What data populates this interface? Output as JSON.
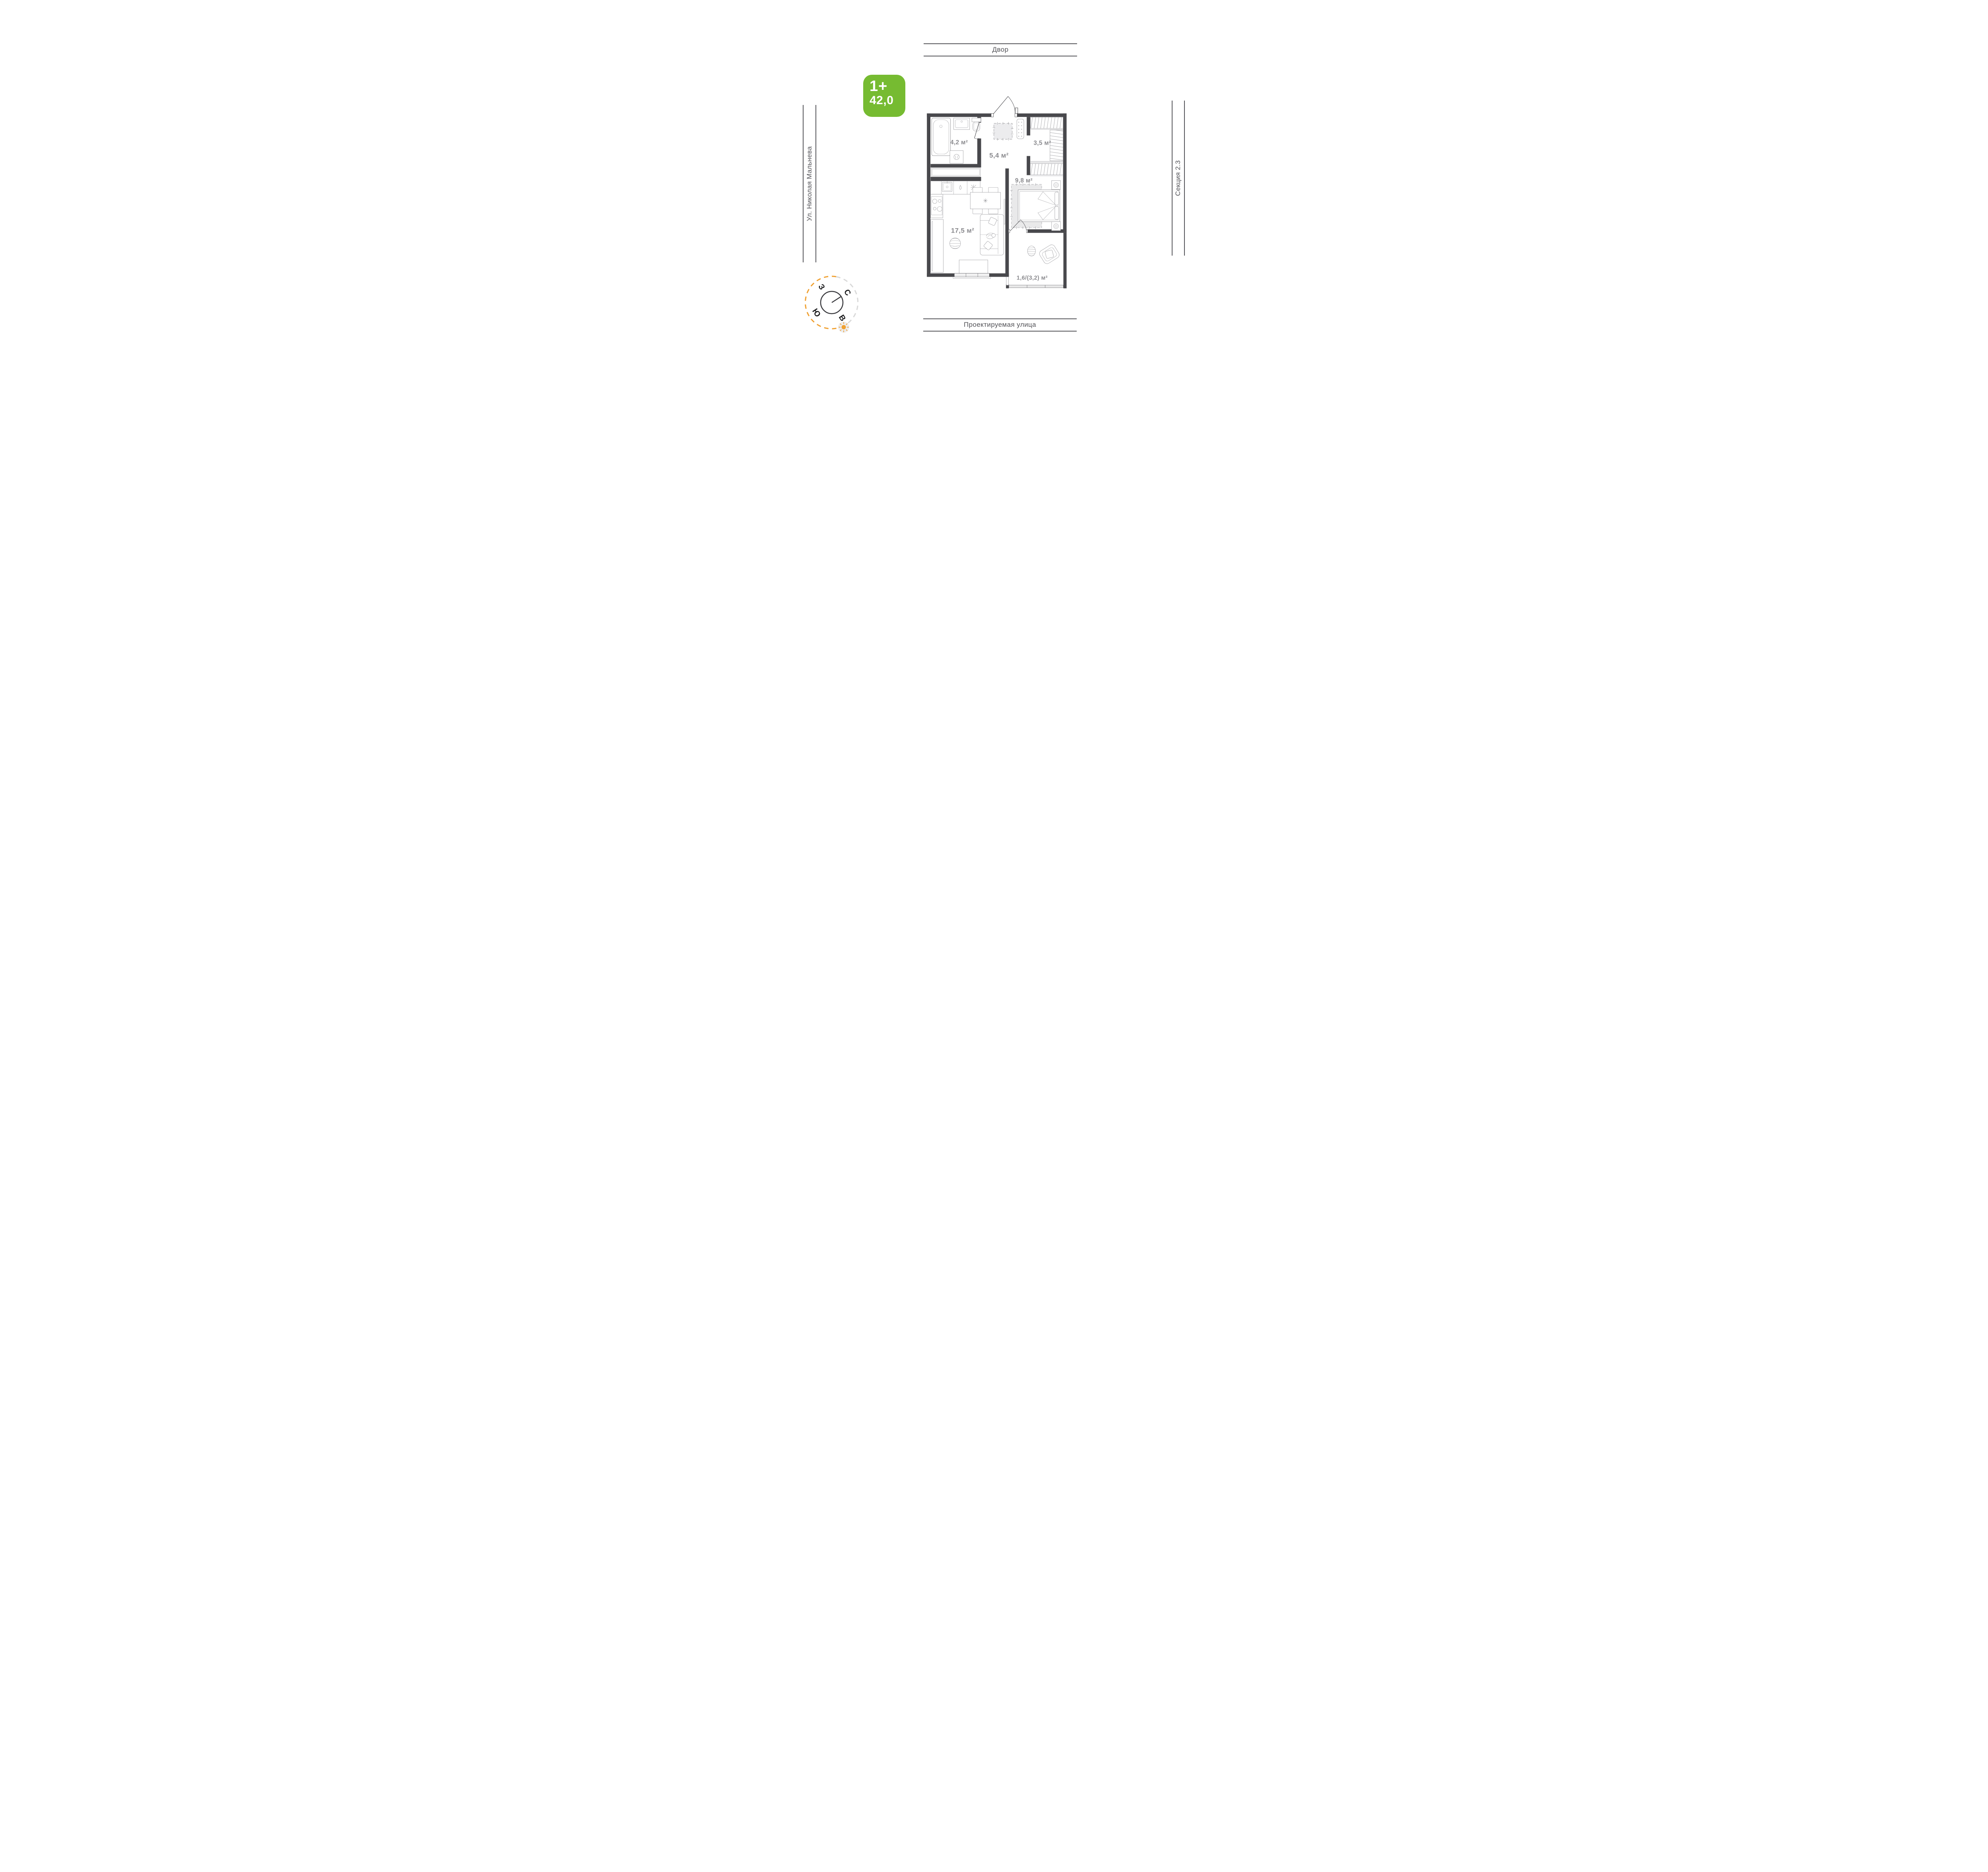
{
  "badge": {
    "rooms_label": "1+",
    "area_value": "42,0"
  },
  "streets": {
    "top": "Двор",
    "bottom": "Проектируемая улица",
    "left": "Ул. Николая Мальнева",
    "right": "Секция 2.3"
  },
  "plan": {
    "rooms": {
      "bathroom": "4,2 м²",
      "hallway": "5,4 м²",
      "wardrobe": "3,5 м²",
      "bedroom": "9,8 м²",
      "living": "17,5 м²",
      "balcony": "1,6/(3,2) м²"
    }
  },
  "compass": {
    "letters": {
      "north": "С",
      "east": "В",
      "south": "Ю",
      "west": "З"
    }
  },
  "colors": {
    "accent_green": "#76bb31",
    "wall": "#48484c",
    "fixture": "#9d9da1",
    "room_label": "#8a8a8e",
    "street_line": "#55555a",
    "compass_orange": "#f0a132",
    "zone_fill": "#e9e9ea"
  }
}
